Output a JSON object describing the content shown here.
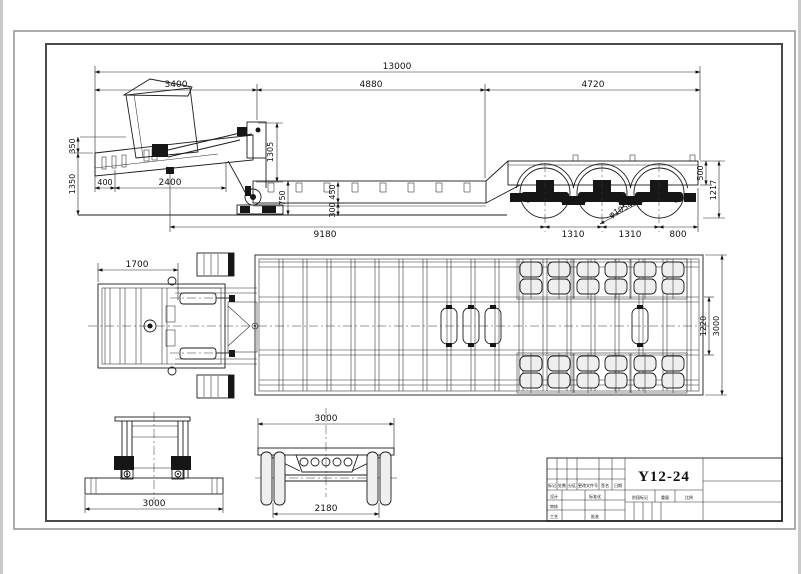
{
  "drawing": {
    "number": "Y12-24"
  },
  "side_view": {
    "overall_length": "13000",
    "front_section": "3400",
    "mid_section": "4880",
    "rear_section": "4720",
    "front_deck_height": "350",
    "overall_height": "1350",
    "kingpin_setback": "400",
    "neck_length": "2400",
    "neck_height": "1305",
    "deck_height": "750",
    "frame_depth": "450",
    "ground_clearance": "300",
    "kingpin_to_bogie": "9180",
    "axle_space_1": "1310",
    "axle_space_2": "1310",
    "rear_overhang": "800",
    "tire_dia": "φ1054",
    "rear_frame_depth": "500",
    "rear_height": "1217"
  },
  "plan_view": {
    "gooseneck_front": "1700",
    "frame_width": "1220",
    "overall_width": "3000"
  },
  "front_view": {
    "overall_width": "3000"
  },
  "rear_view": {
    "overall_width": "3000",
    "track": "2180"
  },
  "title_block": {
    "drawing_number": "Y12-24",
    "header_mark": "标记",
    "header_count": "处数",
    "header_zone": "分区",
    "header_change_doc": "更改文件号",
    "header_sign": "签名",
    "header_date": "日期",
    "design": "设计",
    "standardization": "标准化",
    "check": "审核",
    "process": "工艺",
    "approve": "批准",
    "stage_mark": "阶段标记",
    "weight": "重量",
    "scale": "比例"
  }
}
